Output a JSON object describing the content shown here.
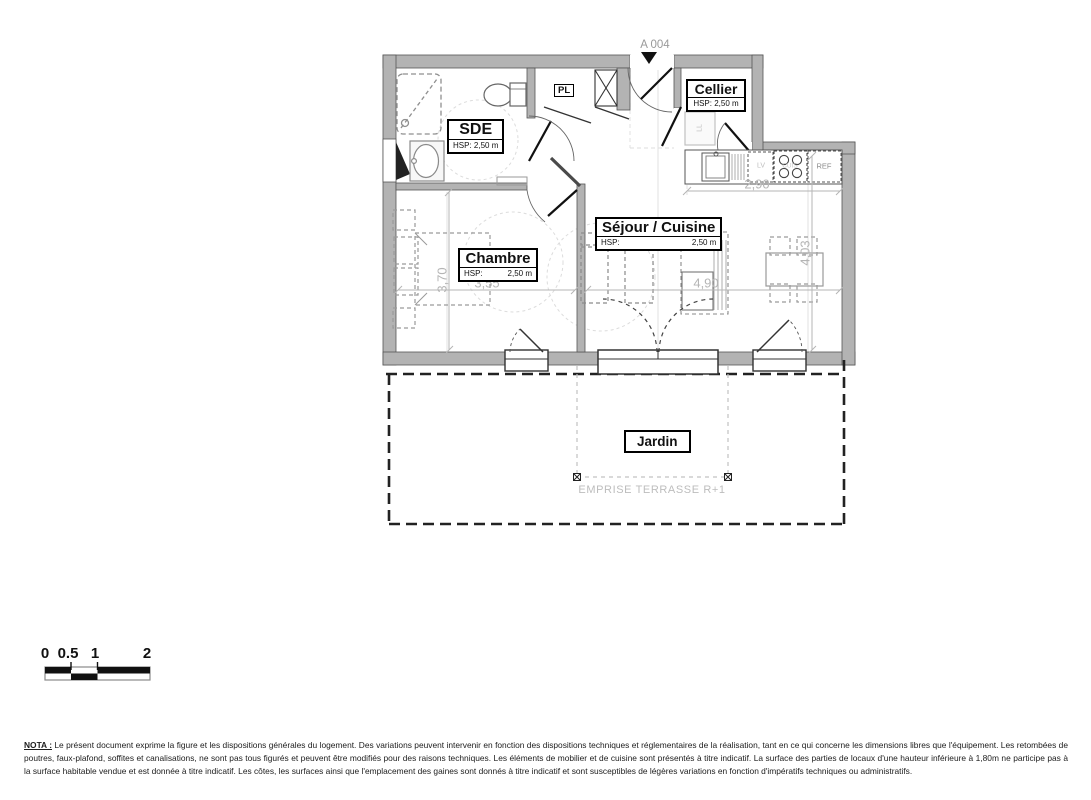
{
  "plan": {
    "unit_ref": "A 004",
    "rooms": {
      "sde": {
        "name": "SDE",
        "hsp": "HSP: 2,50 m"
      },
      "cellier": {
        "name": "Cellier",
        "hsp": "HSP: 2,50 m"
      },
      "chambre": {
        "name": "Chambre",
        "hsp_key": "HSP:",
        "hsp_val": "2,50 m"
      },
      "sejour": {
        "name": "Séjour / Cuisine",
        "hsp_key": "HSP:",
        "hsp_val": "2,50 m"
      },
      "jardin": {
        "name": "Jardin"
      }
    },
    "closet_label": "PL",
    "appliances": {
      "washer": "LL",
      "dishwasher": "LV",
      "cooktop": "CUIS",
      "fridge": "REF"
    },
    "dimensions": {
      "chambre_depth": "3,70",
      "chambre_width": "3,55",
      "sejour_width": "4,90",
      "sejour_depth": "4,03",
      "kitchen_width": "2,90"
    },
    "terrace_note": "EMPRISE TERRASSE R+1"
  },
  "scale_bar": {
    "labels": [
      "0",
      "0.5",
      "1",
      "2"
    ]
  },
  "nota": {
    "title": "NOTA :",
    "body": "Le présent document exprime la figure et les dispositions générales du logement. Des variations peuvent intervenir en fonction des dispositions techniques et réglementaires de la réalisation, tant en ce qui concerne les dimensions libres que l'équipement. Les retombées de poutres, faux-plafond, soffites et canalisations, ne sont pas tous figurés et peuvent être modifiés pour des raisons techniques. Les éléments de mobilier et de cuisine sont présentés à titre indicatif. La surface des parties de locaux d'une hauteur inférieure à 1,80m ne participe pas à la surface habitable vendue et est donnée à titre indicatif. Les côtes, les surfaces ainsi que l'emplacement des gaines sont donnés à titre indicatif et sont susceptibles de légères variations en fonction d'impératifs techniques ou administratifs."
  },
  "colors": {
    "wall_fill": "#b3b3b3",
    "dimension_gray": "#b5b5b5",
    "line_black": "#111111"
  }
}
